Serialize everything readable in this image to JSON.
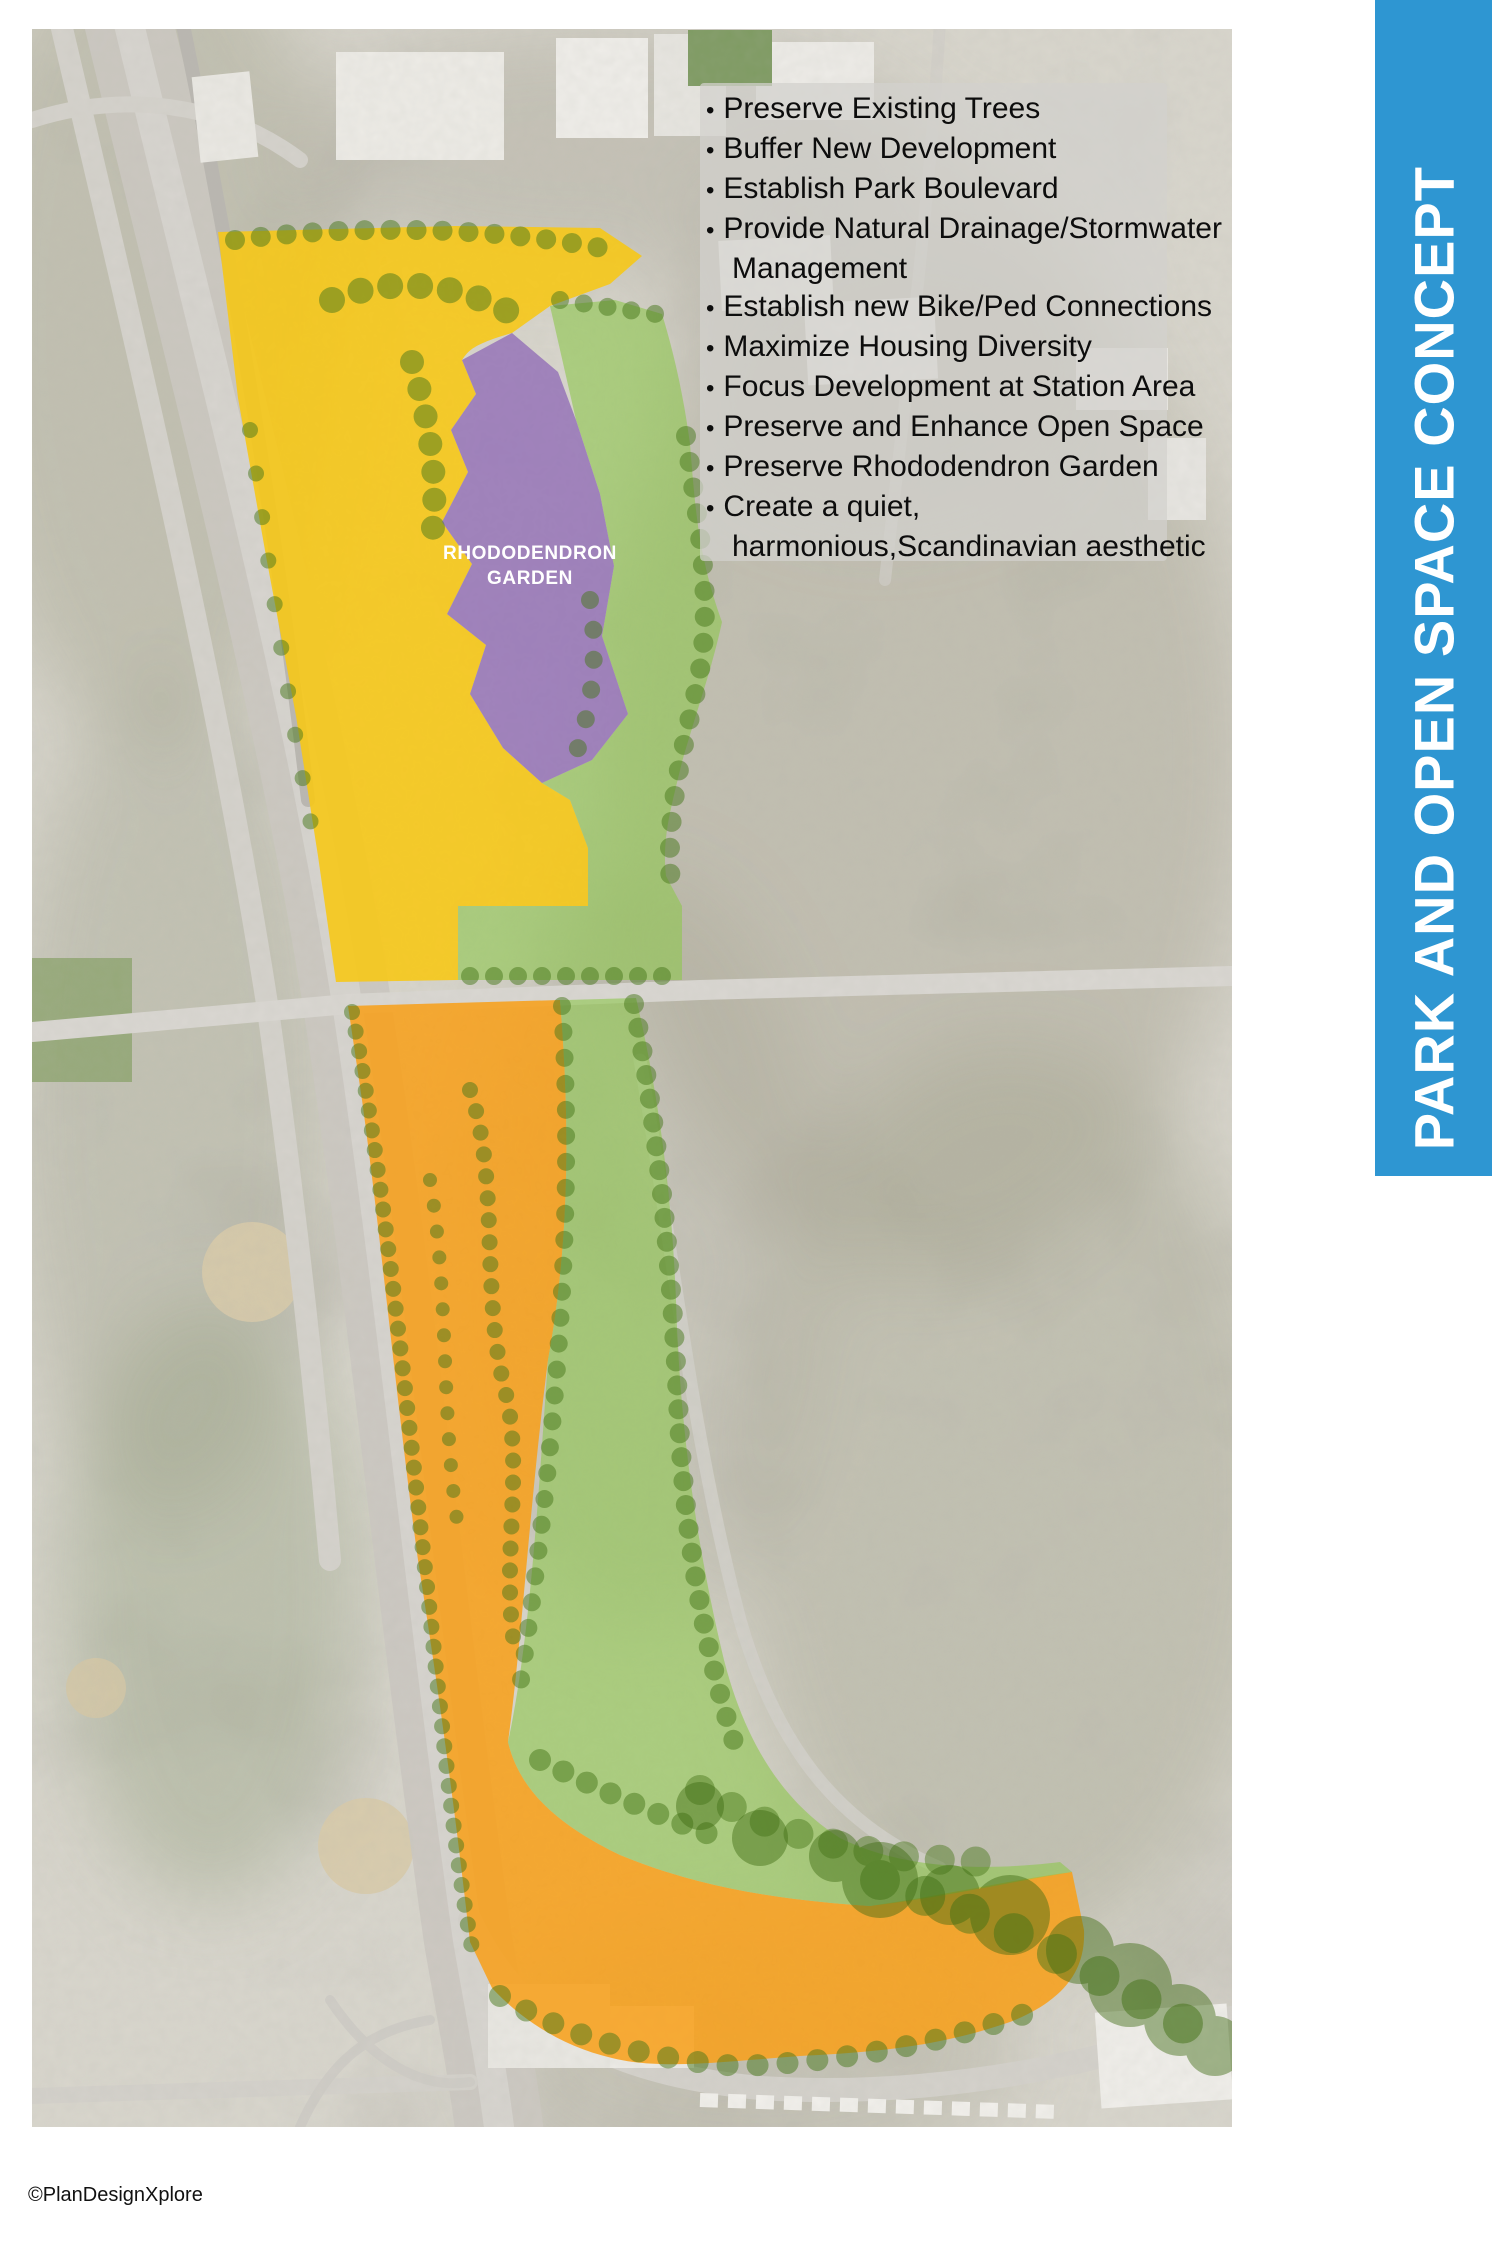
{
  "banner": {
    "title": "PARK AND OPEN SPACE CONCEPT",
    "bg_color": "#2e96d2",
    "text_color": "#ffffff"
  },
  "principles": {
    "items": [
      "Preserve Existing Trees",
      "Buffer New Development",
      "Establish Park Boulevard",
      "Provide Natural Drainage/Stormwater Management",
      "Establish new Bike/Ped Connections",
      "Maximize Housing Diversity",
      "Focus Development at Station Area",
      "Preserve and Enhance Open Space",
      "Preserve Rhododendron Garden",
      "Create a quiet, harmonious,Scandinavian aesthetic"
    ]
  },
  "map": {
    "garden_label": {
      "line1": "RHODODENDRON",
      "line2": "GARDEN"
    },
    "zone_colors": {
      "park_yellow": "#f6c818",
      "corridor_orange": "#f7a11c",
      "buffer_green": "#8fc750",
      "garden_purple": "#9b7cb9",
      "tree_green": "#47761a"
    }
  },
  "footer": {
    "credit": "©PlanDesignXplore"
  }
}
